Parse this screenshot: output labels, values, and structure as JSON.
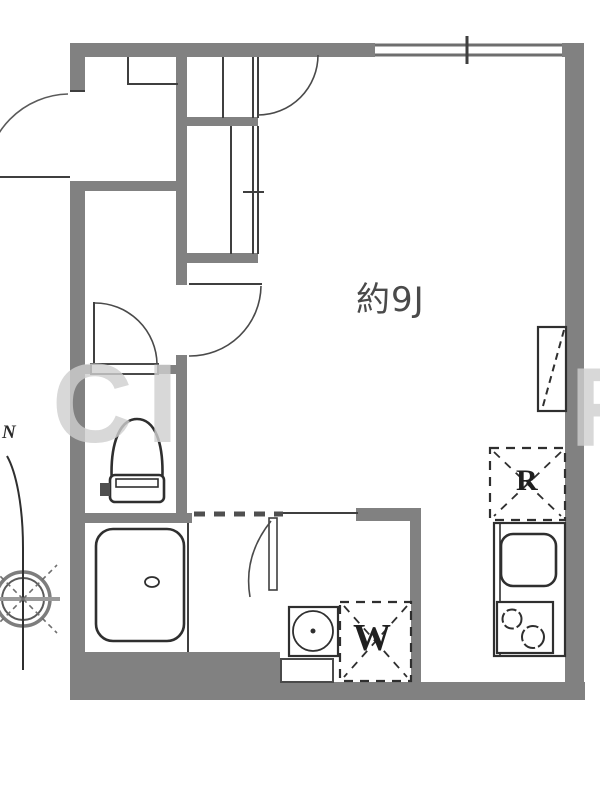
{
  "plan": {
    "type": "floor-plan",
    "labels": {
      "room_area": "約9J",
      "refrigerator_space": "R",
      "washing_machine_space": "W",
      "compass_north": "N"
    },
    "watermark": {
      "left": "CI",
      "right": "R"
    },
    "colors": {
      "wall": "#818181",
      "line": "#3f3f3f",
      "fixture_outline": "#333333",
      "label_text": "#4a4a4a",
      "watermark": "#cfcfcf",
      "background": "#ffffff"
    }
  }
}
